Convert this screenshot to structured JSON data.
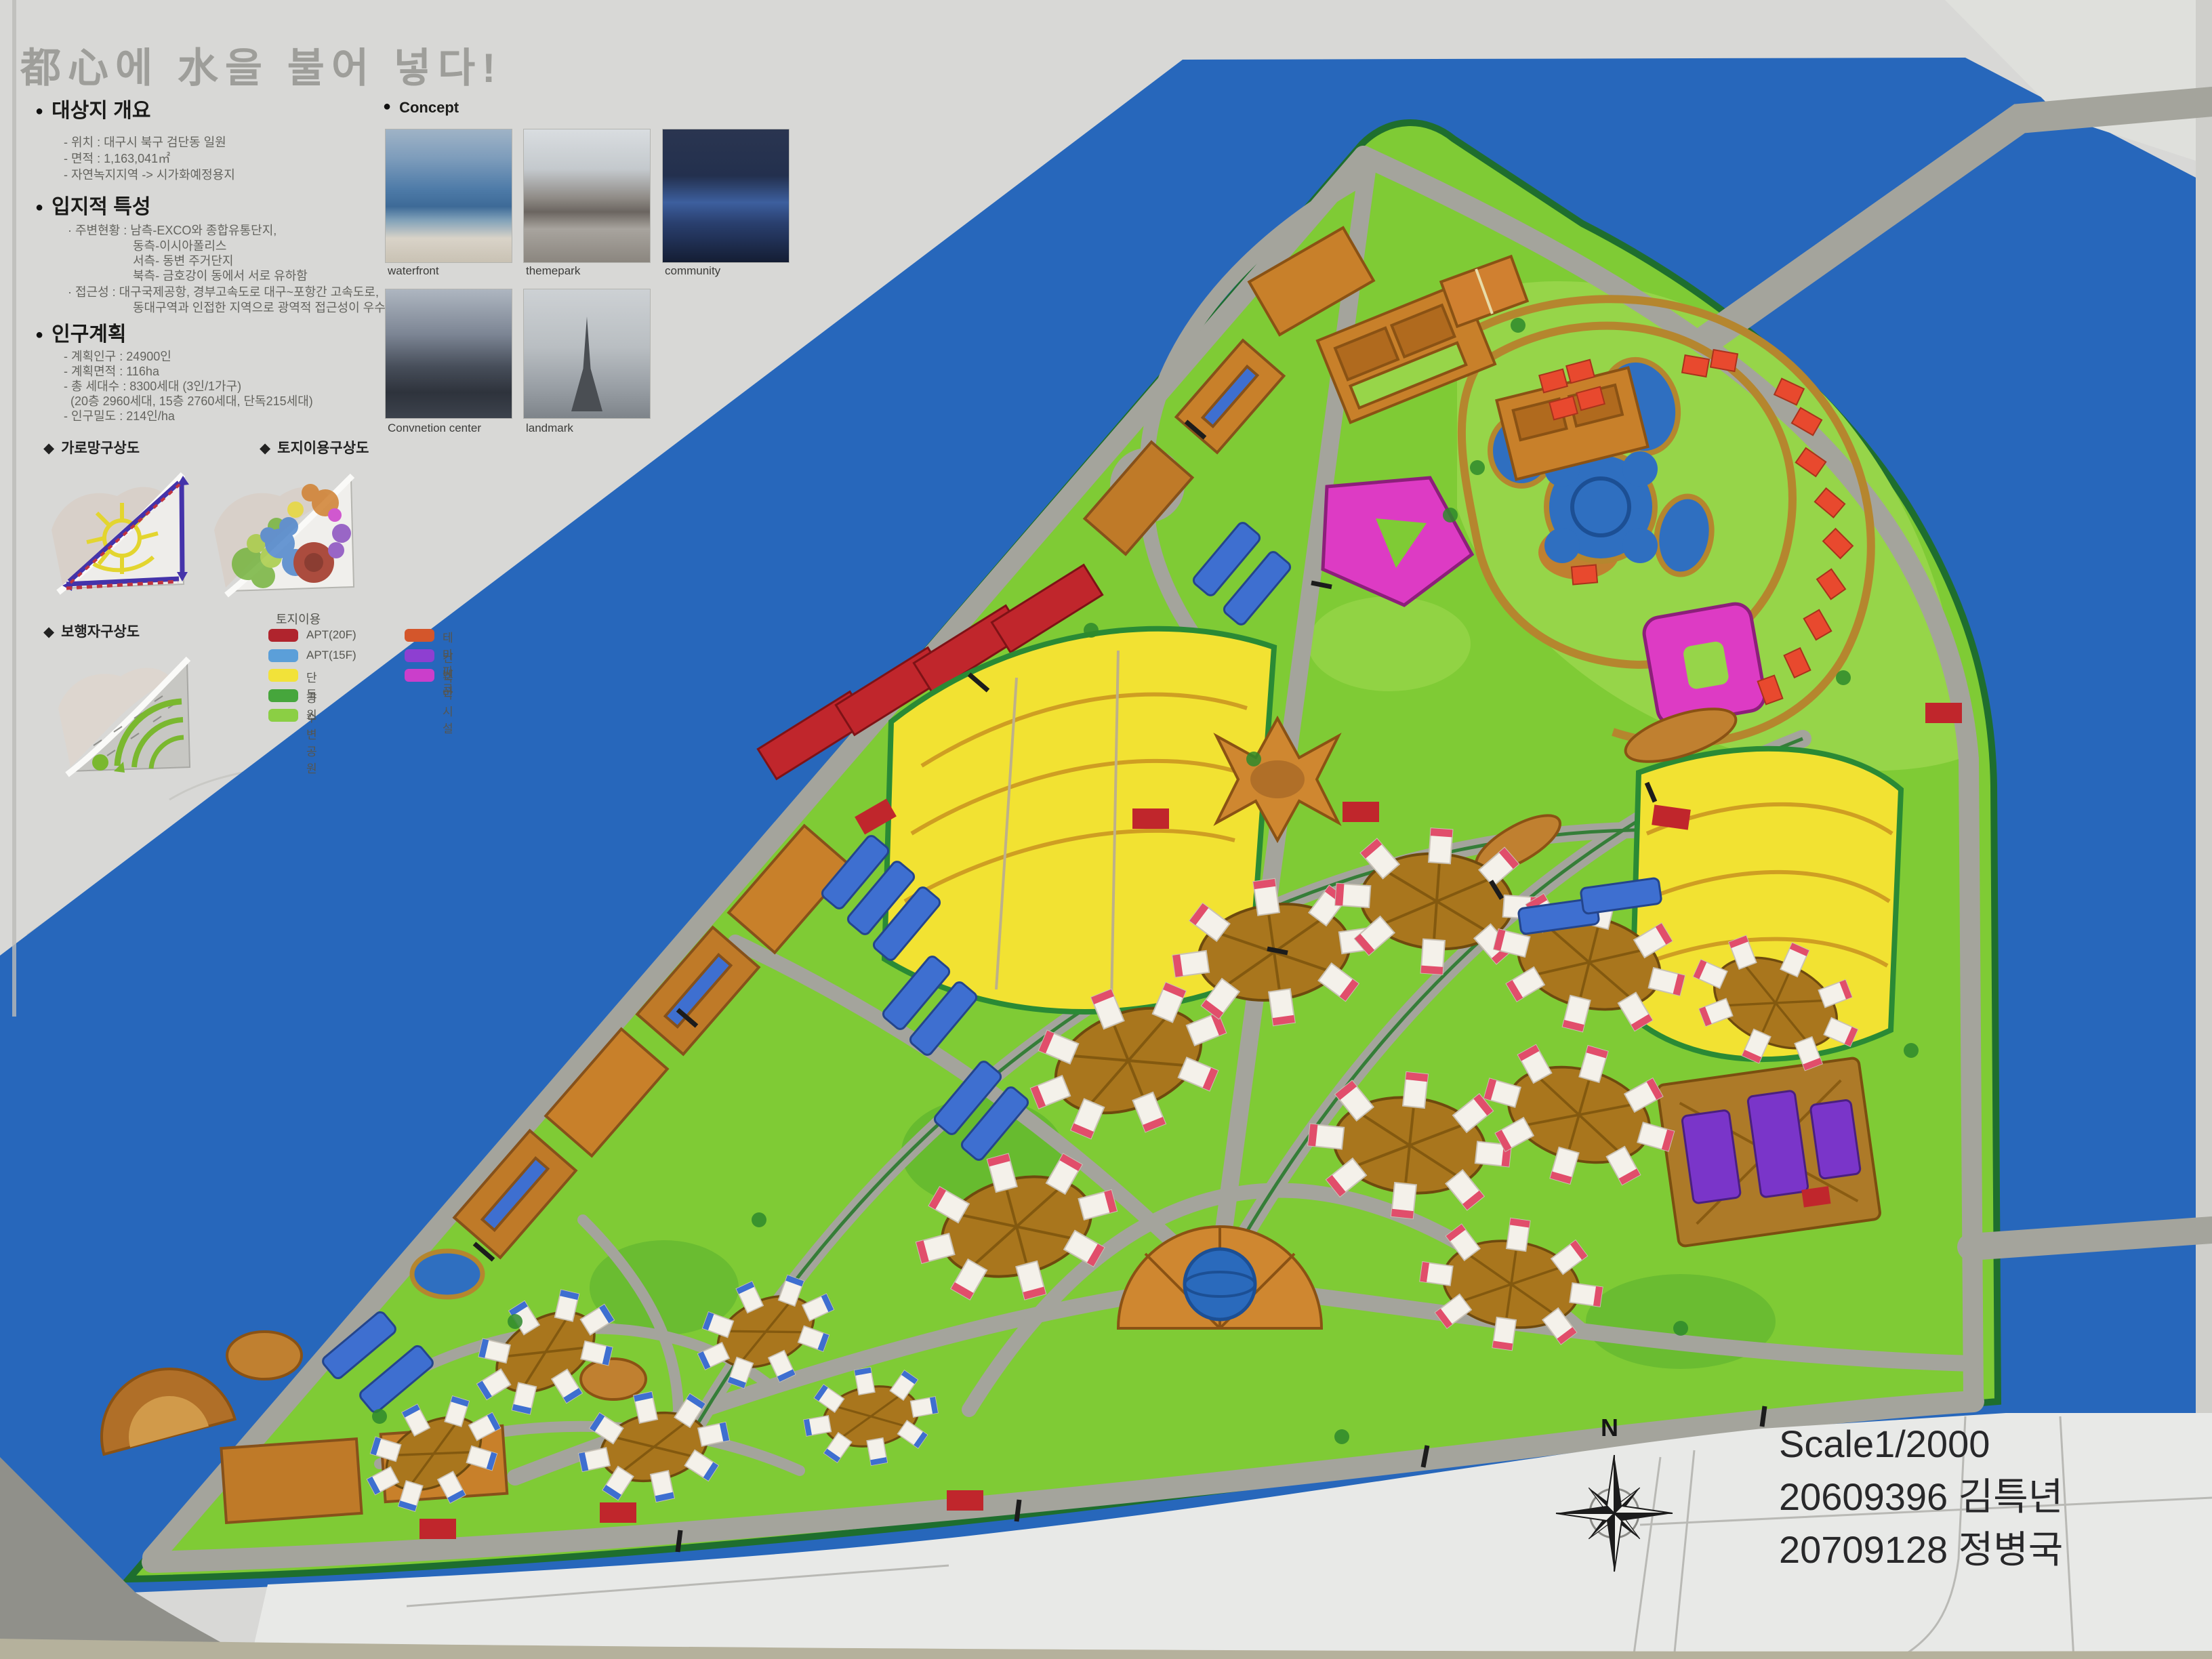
{
  "icons": {
    "bullet": "●",
    "diamond": "◆"
  },
  "title": "都心에 水을 불어 넣다!",
  "sections": {
    "overview": {
      "heading": "대상지 개요",
      "items": [
        "- 위치 : 대구시 북구 검단동 일원",
        "- 면적 : 1,163,041㎡",
        "- 자연녹지지역 -> 시가화예정용지"
      ]
    },
    "location": {
      "heading": "입지적 특성",
      "items": [
        "· 주변현황 : 남측-EXCO와 종합유통단지,",
        "동측-이시아폴리스",
        "서측- 동변 주거단지",
        "북측- 금호강이 동에서 서로 유하함",
        "· 접근성 : 대구국제공항, 경부고속도로 대구~포항간 고속도로,",
        "동대구역과 인접한 지역으로 광역적 접근성이 우수한 지역"
      ]
    },
    "population": {
      "heading": "인구계획",
      "items": [
        "- 계획인구 : 24900인",
        "- 계획면적 : 116ha",
        "- 총 세대수 : 8300세대 (3인/1가구)",
        "(20층 2960세대, 15층 2760세대, 단독215세대)",
        "- 인구밀도 : 214인/ha"
      ]
    }
  },
  "concept": {
    "heading": "Concept",
    "images": [
      {
        "label": "waterfront"
      },
      {
        "label": "themepark"
      },
      {
        "label": "community"
      },
      {
        "label": "Convnetion center"
      },
      {
        "label": "landmark"
      }
    ]
  },
  "diagrams": [
    {
      "label": "가로망구상도"
    },
    {
      "label": "토지이용구상도"
    },
    {
      "label": "보행자구상도"
    }
  ],
  "legend": {
    "title": "토지이용",
    "left": [
      {
        "label": "APT(20F)",
        "color": "#b0242d"
      },
      {
        "label": "APT(15F)",
        "color": "#5b9fd9"
      },
      {
        "label": "단독",
        "color": "#f2e239"
      },
      {
        "label": "공원",
        "color": "#46a63c"
      },
      {
        "label": "수변공원",
        "color": "#8bcf44"
      }
    ],
    "right": [
      {
        "label": "테마파크",
        "color": "#d4562b"
      },
      {
        "label": "컨벤션",
        "color": "#8e3fd1"
      },
      {
        "label": "숙박시설",
        "color": "#cb3ecb"
      }
    ]
  },
  "footer": {
    "scale": "Scale1/2000",
    "students": [
      "20609396 김특년",
      "20709128 정병국"
    ],
    "compass_label": "N"
  },
  "map_colors": {
    "river": "#2767bb",
    "park_green": "#7fcb35",
    "waterfront_green": "#96d549",
    "road": "#a4a49c",
    "theme_orange": "#c8802a",
    "apt20_red": "#c0262c",
    "apt15_blue": "#3e6fd0",
    "detached_yellow": "#f2e232",
    "hotel_magenta": "#dd3bc4",
    "convention_purple": "#7a35c9",
    "paper": "#d8d8d6"
  }
}
